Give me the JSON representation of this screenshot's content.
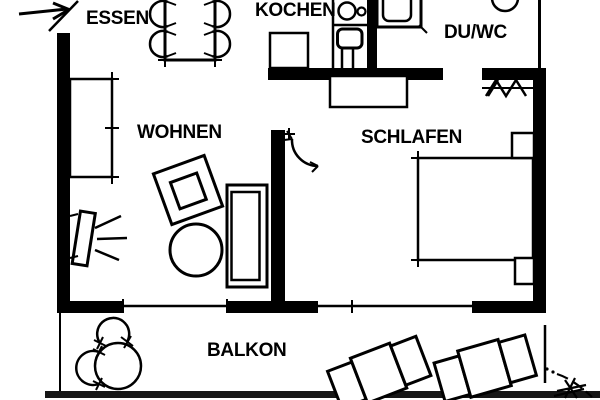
{
  "plan": {
    "type": "apartment-floor-plan",
    "background": "#ffffff",
    "line_color": "#000000",
    "balcony_edge_color": "#161616"
  },
  "rooms": {
    "essen": {
      "label": "ESSEN"
    },
    "kochen": {
      "label": "KOCHEN"
    },
    "duwc": {
      "label": "DU/WC"
    },
    "wohnen": {
      "label": "WOHNEN"
    },
    "schlafen": {
      "label": "SCHLAFEN"
    },
    "balkon": {
      "label": "BALKON"
    }
  },
  "icons": {
    "entrance_arrow": "entry-direction-arrow",
    "furniture": [
      "dining-table-with-four-chairs",
      "tall-cupboard",
      "kitchen-cooktop-sink-unit",
      "kitchen-counter",
      "shower-tray",
      "toilet",
      "coat-rack-zigzag",
      "door-swing-arc",
      "wardrobe",
      "double-bed",
      "nightstand",
      "nightstand",
      "tv-on-stand",
      "armchair",
      "round-coffee-table",
      "sofa",
      "balcony-round-table",
      "balcony-chair",
      "balcony-chair",
      "sun-lounger",
      "sun-lounger",
      "balcony-plant"
    ]
  }
}
